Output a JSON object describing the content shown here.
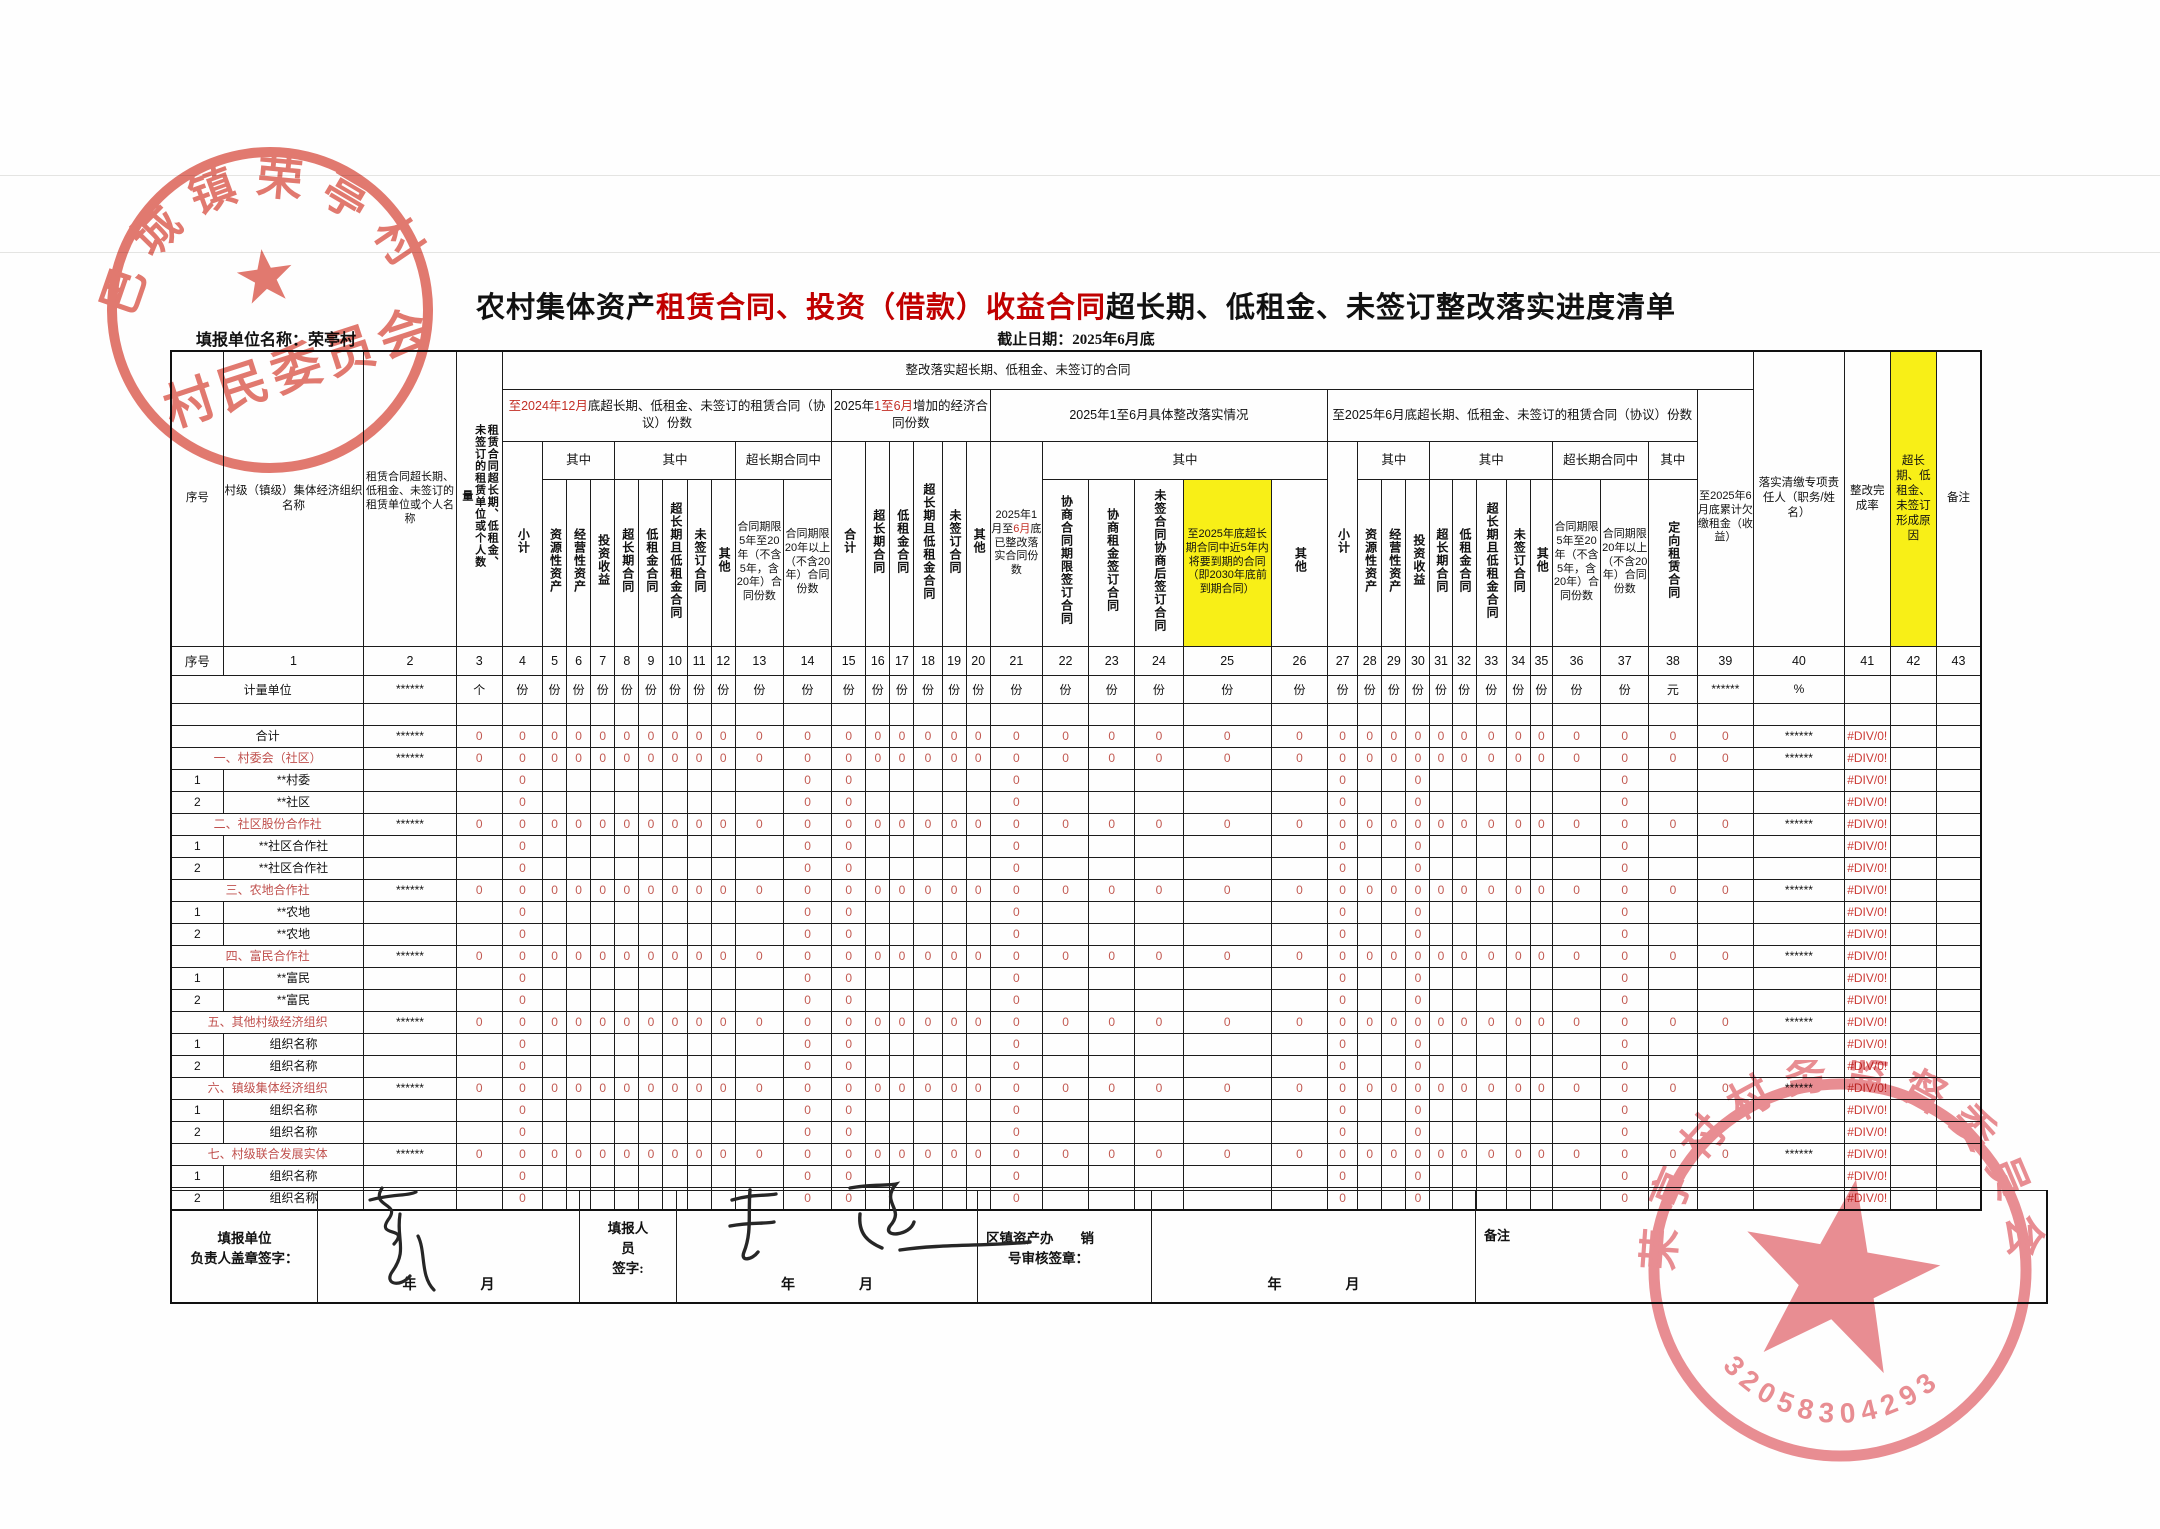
{
  "page": {
    "title_black1": "农村集体资产",
    "title_red": "租赁合同、投资（借款）收益合同",
    "title_black2": "超长期、低租金、未签订整改落实进度清单",
    "unit_label": "填报单位名称：",
    "unit_value": "荣亭村",
    "deadline": "截止日期：2025年6月底"
  },
  "header": {
    "banner": "整改落实超长期、低租金、未签订的合同",
    "g1_red": "至2024年12月",
    "g1_rest": "底超长期、低租金、未签订的租赁合同（协议）份数",
    "g2_pre": "2025年",
    "g2_red": "1至6月",
    "g2_rest": "增加的经济合同份数",
    "g3": "2025年1至6月具体整改落实情况",
    "g4": "至2025年6月底超长期、低租金、未签订的租赁合同（协议）份数",
    "zhong": "其中",
    "super_mid": "超长期合同中",
    "seq": "序号",
    "c1": "村级（镇级）集体经济组织名称",
    "c2": "租赁合同超长期、低租金、未签订的租赁单位或个人名称",
    "c3": "租赁合同超长期、低租金、未签订的租赁单位或个人数量",
    "xiaoji": "小计",
    "heji": "合计",
    "res_asset": "资源性资产",
    "op_asset": "经营性资产",
    "invest": "投资收益",
    "longterm": "超长期合同",
    "lowrent": "低租金合同",
    "longlow": "超长期且低租金合同",
    "unsigned": "未签订合同",
    "other": "其他",
    "t5_20": "合同期限5年至20年（不含5年，含20年）合同份数",
    "t20p": "合同期限20年以上（不含20年）合同份数",
    "c21_pre": "2025年1月至",
    "c21_red": "6月",
    "c21_rest": "底已整改落实合同份数",
    "c22": "协商合同期限签订合同",
    "c23": "协商租金签订合同",
    "c24": "未签合同协商后签订合同",
    "c25": "至2025年底超长期合同中近5年内将要到期的合同（即2030年底前到期合同）",
    "c38": "定向租赁合同",
    "c39": "至2025年6月底累计欠缴租金（收益）",
    "c40": "落实清缴专项责任人（职务/姓名）",
    "c41": "整改完成率",
    "c42": "超长期、低租金、未签订形成原因",
    "c43": "备注"
  },
  "numbers_row": [
    "序号",
    "1",
    "2",
    "3",
    "4",
    "5",
    "6",
    "7",
    "8",
    "9",
    "10",
    "11",
    "12",
    "13",
    "14",
    "15",
    "16",
    "17",
    "18",
    "19",
    "20",
    "21",
    "22",
    "23",
    "24",
    "25",
    "26",
    "27",
    "28",
    "29",
    "30",
    "31",
    "32",
    "33",
    "34",
    "35",
    "36",
    "37",
    "38",
    "39",
    "40",
    "41",
    "42",
    "43"
  ],
  "units_row": [
    "计量单位",
    "******",
    "个",
    "份",
    "份",
    "份",
    "份",
    "份",
    "份",
    "份",
    "份",
    "份",
    "份",
    "份",
    "份",
    "份",
    "份",
    "份",
    "份",
    "份",
    "份",
    "份",
    "份",
    "份",
    "份",
    "份",
    "份",
    "份",
    "份",
    "份",
    "份",
    "份",
    "份",
    "份",
    "份",
    "份",
    "份",
    "元",
    "******",
    "%",
    "",
    ""
  ],
  "cells": {
    "zero": "0",
    "stars": "******",
    "div0": "#DIV/0!"
  },
  "table": {
    "cat_zero_from": 3,
    "cat_zero_to": 39,
    "sub_zero_cols": [
      4,
      14,
      15,
      21,
      27,
      30,
      37
    ],
    "rows": [
      {
        "type": "blank"
      },
      {
        "type": "cat",
        "name": "合计",
        "red": false
      },
      {
        "type": "cat",
        "name": "一、村委会（社区）",
        "red": true
      },
      {
        "type": "sub",
        "seq": "1",
        "name": "**村委"
      },
      {
        "type": "sub",
        "seq": "2",
        "name": "**社区"
      },
      {
        "type": "cat",
        "name": "二、社区股份合作社",
        "red": true
      },
      {
        "type": "sub",
        "seq": "1",
        "name": "**社区合作社"
      },
      {
        "type": "sub",
        "seq": "2",
        "name": "**社区合作社"
      },
      {
        "type": "cat",
        "name": "三、农地合作社",
        "red": true
      },
      {
        "type": "sub",
        "seq": "1",
        "name": "**农地"
      },
      {
        "type": "sub",
        "seq": "2",
        "name": "**农地"
      },
      {
        "type": "cat",
        "name": "四、富民合作社",
        "red": true
      },
      {
        "type": "sub",
        "seq": "1",
        "name": "**富民"
      },
      {
        "type": "sub",
        "seq": "2",
        "name": "**富民"
      },
      {
        "type": "cat",
        "name": "五、其他村级经济组织",
        "red": true
      },
      {
        "type": "sub",
        "seq": "1",
        "name": "组织名称"
      },
      {
        "type": "sub",
        "seq": "2",
        "name": "组织名称"
      },
      {
        "type": "cat",
        "name": "六、镇级集体经济组织",
        "red": true
      },
      {
        "type": "sub",
        "seq": "1",
        "name": "组织名称"
      },
      {
        "type": "sub",
        "seq": "2",
        "name": "组织名称"
      },
      {
        "type": "cat",
        "name": "七、村级联合发展实体",
        "red": true
      },
      {
        "type": "sub",
        "seq": "1",
        "name": "组织名称"
      },
      {
        "type": "sub",
        "seq": "2",
        "name": "组织名称"
      }
    ]
  },
  "bottom": {
    "a1": "填报单位",
    "a2": "负责人盖章签字：",
    "c1": "填报人",
    "c2": "员",
    "c3": "签字:",
    "e1": "区镇资产办　　销",
    "e2": "号审核签章：",
    "year": "年",
    "month": "月",
    "remark": "备注"
  },
  "stamps": {
    "s1_arc": "巴城镇荣亭村",
    "s1_mid": "村民委员会",
    "s2_arc": "荣亭村村务监督委员会",
    "s2_num": "3205830429390"
  }
}
